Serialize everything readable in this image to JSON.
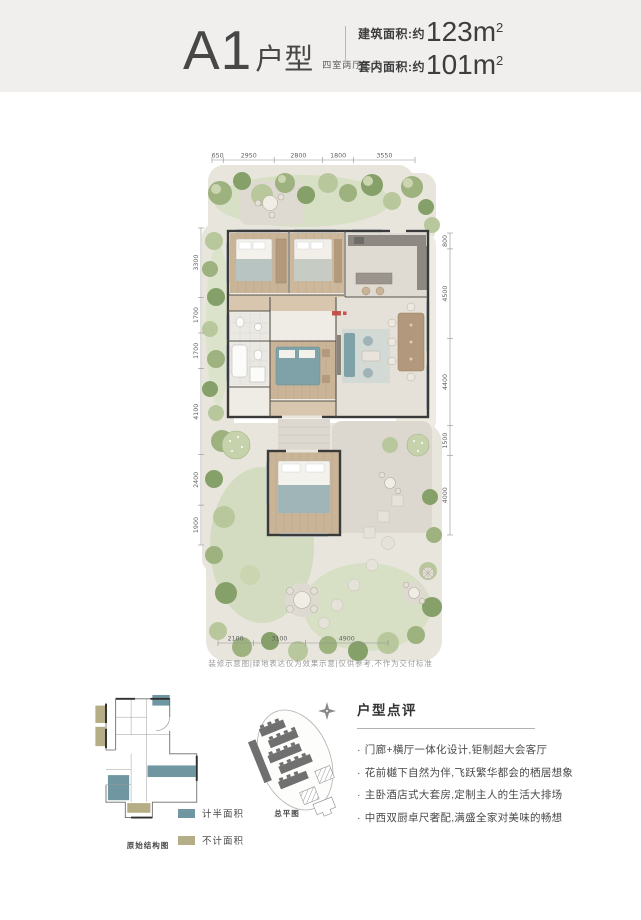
{
  "header": {
    "plan_code": "A1",
    "plan_suffix": "户型",
    "layout_desc": "四室两厅三卫",
    "area_rows": [
      {
        "label": "建筑面积:约",
        "value": "123",
        "unit": "m",
        "sup": "2"
      },
      {
        "label": "套内面积:约",
        "value": "101",
        "unit": "m",
        "sup": "2"
      }
    ]
  },
  "floor_plan": {
    "dims": {
      "top": [
        "650",
        "2950",
        "2800",
        "1800",
        "3550"
      ],
      "left": [
        "3300",
        "1700",
        "1700",
        "4100",
        "2400",
        "1900"
      ],
      "right": [
        "800",
        "4500",
        "4400",
        "1500",
        "4000"
      ],
      "bottom": [
        "2100",
        "3100",
        "4900"
      ]
    },
    "disclaimer": "装修示意图|绿地表达仅为效果示意|仅供参考,不作为交付标准"
  },
  "structure_plan": {
    "caption": "原始结构图",
    "legend": [
      {
        "swatch_color": "#7097a1",
        "label": "计半面积"
      },
      {
        "swatch_color": "#b5ad85",
        "label": "不计面积"
      }
    ]
  },
  "site_plan": {
    "caption": "总平图"
  },
  "review": {
    "title": "户型点评",
    "bullet_marker": "·",
    "bullets": [
      "门廊+横厅一体化设计,钜制超大会客厅",
      "花前樾下自然为伴,飞跃繁华都会的栖居想象",
      "主卧酒店式大套房,定制主人的生活大排场",
      "中西双厨卓尺奢配,满盛全家对美味的畅想"
    ]
  },
  "colors": {
    "header_bg": "#f0efed",
    "accent_teal": "#7097a1",
    "accent_olive": "#b5ad85",
    "garden_green": "#9db27f",
    "wood_floor": "#c9b498"
  }
}
